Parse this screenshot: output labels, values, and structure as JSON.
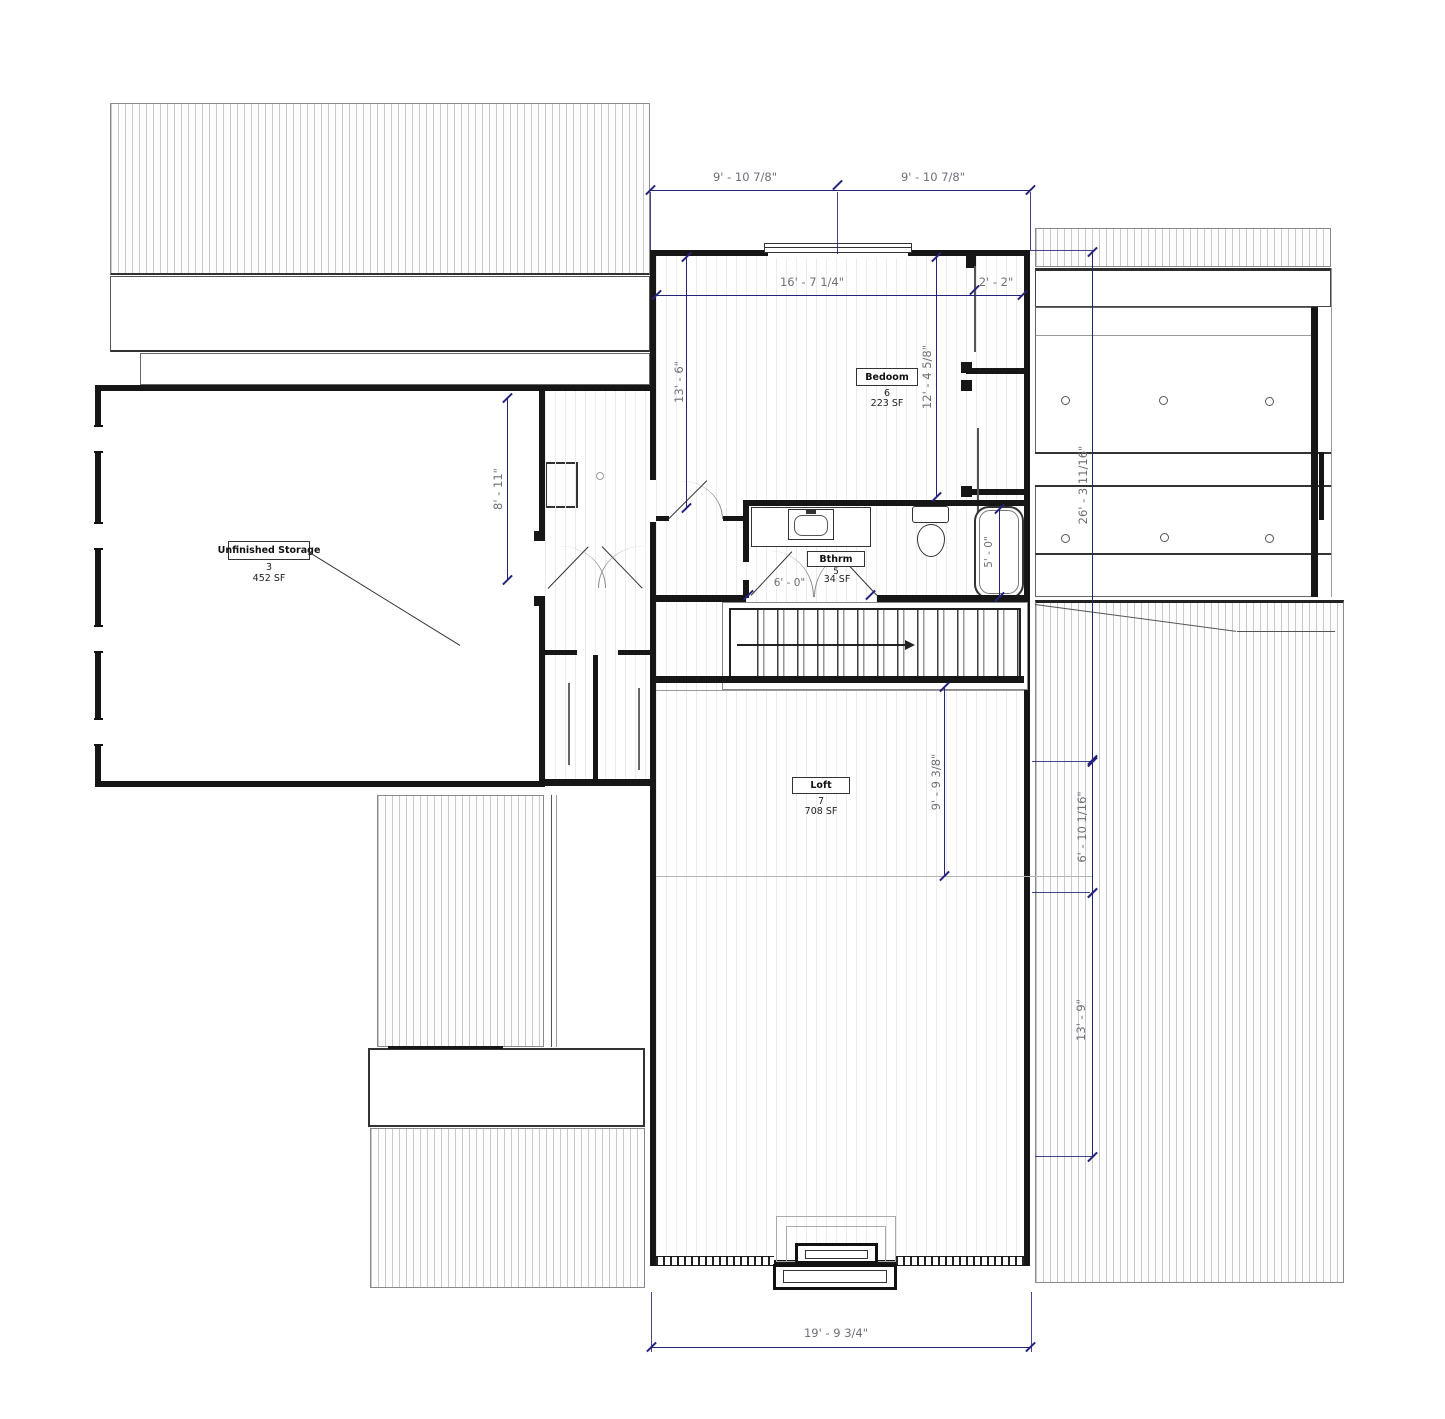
{
  "rooms": {
    "storage": {
      "name": "Unfinished Storage",
      "number": "3",
      "area": "452 SF"
    },
    "bedroom": {
      "name": "Bedoom",
      "number": "6",
      "area": "223 SF"
    },
    "bathroom": {
      "name": "Bthrm",
      "number": "5",
      "area": "34 SF"
    },
    "loft": {
      "name": "Loft",
      "number": "7",
      "area": "708 SF"
    }
  },
  "dims": {
    "top_left": "9' - 10 7/8\"",
    "top_right": "9' - 10 7/8\"",
    "bedroom_width": "16' - 7 1/4\"",
    "closet_depth": "2' - 2\"",
    "bedroom_height_left": "13' - 6\"",
    "bedroom_height_right": "12' - 4 5/8\"",
    "storage_east": "8' - 11\"",
    "bath_width": "6' - 0\"",
    "tub_length": "5' - 0\"",
    "loft_depth": "9' - 9 3/8\"",
    "right_overall": "26' - 3 11/16\"",
    "roof_right_upper": "6' - 10 1/16\"",
    "roof_right_lower": "13' - 9\"",
    "bottom_width": "19' - 9 3/4\""
  },
  "colors": {
    "dimension": "#23237d",
    "dimension_text": "#6e6e78",
    "wall": "#161616",
    "hatch_line": "#c9c9c9"
  }
}
